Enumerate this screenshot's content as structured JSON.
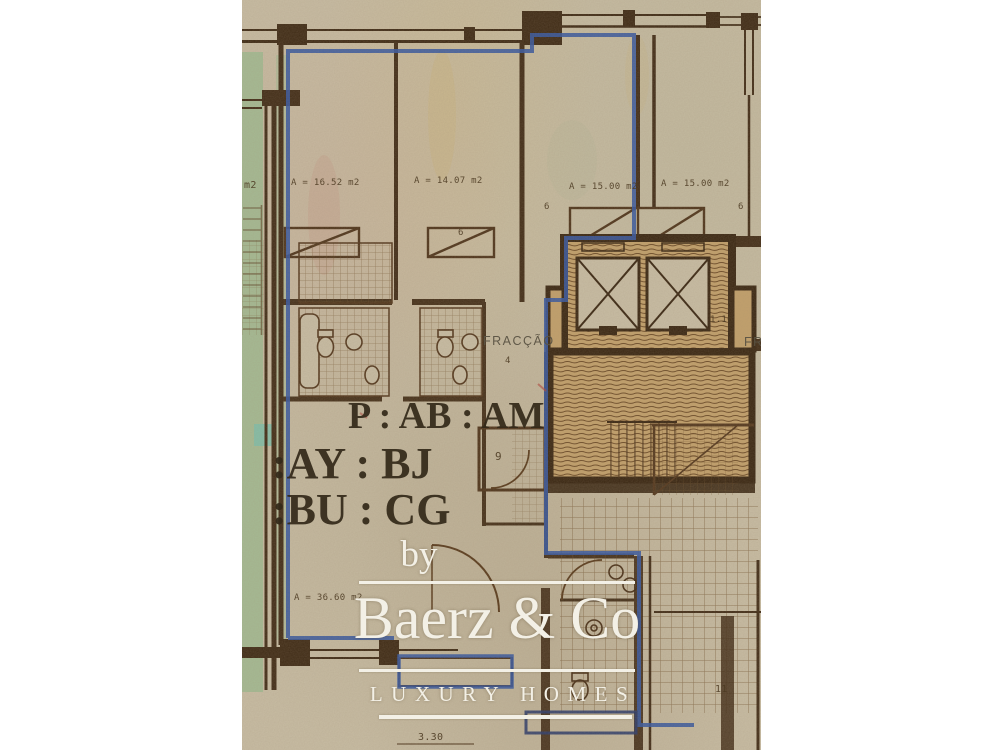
{
  "photo": {
    "description": "Aged architectural floor plan photograph with blue unit outline",
    "labels": {
      "m2_partial": "m2",
      "area_1652": "A = 16.52 m2",
      "area_1407": "A = 14.07 m2",
      "area_1500_left": "A = 15.00 m2",
      "area_1500_right": "A = 15.00 m2",
      "area_3660": "A = 36.60 m2",
      "fraccao": "FRACÇÃO",
      "fraccao_right_partial": "FR",
      "dim_116": "1.16",
      "dim_330": "3.30",
      "room_6a": "6",
      "room_6b": "6",
      "room_6c": "6",
      "room_9": "9",
      "room_4": "4",
      "room_11": "11"
    },
    "codes": {
      "line1": "P : AB : AM",
      "line2": ":AY : BJ",
      "line3": ":BU : CG"
    }
  },
  "logo": {
    "by": "by",
    "brand": "Baerz & Co",
    "tagline": "LUXURY HOMES"
  },
  "colors": {
    "paper": "#c8bda4",
    "wall_brown": "#3f2b16",
    "hatch_brown": "#5f3e1d",
    "highlight_blue": "#3758a0",
    "neighbor_green": "#9cba90",
    "teal_patch": "#7fc0ac",
    "logo_white": "#f3f0e6",
    "code_text": "#332919"
  }
}
